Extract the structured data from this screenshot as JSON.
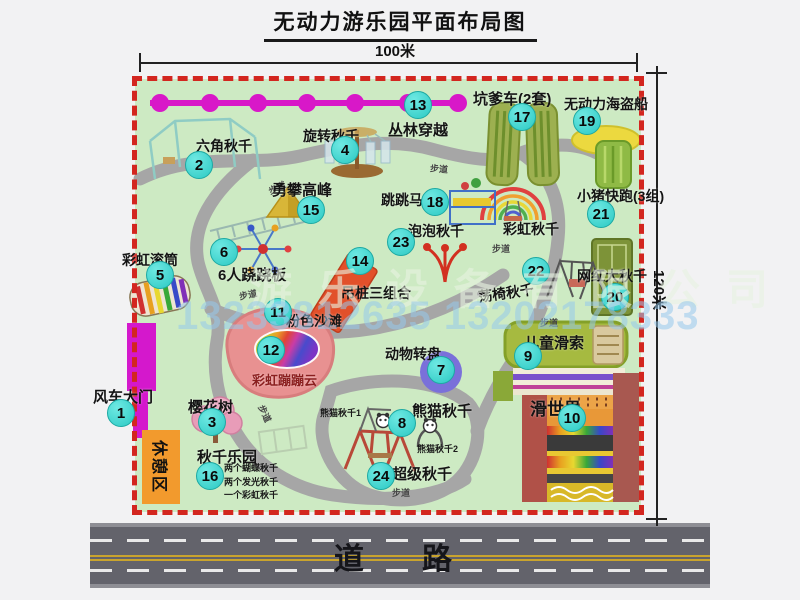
{
  "title": "无动力游乐园平面布局图",
  "dimensions": {
    "width": "100米",
    "height": "120米"
  },
  "road": {
    "label": "道　路"
  },
  "watermark": {
    "company": "游乐设备有限公司",
    "phone": "13233812635 13202178333"
  },
  "park": {
    "rest_area_label": "休憩区",
    "attractions": [
      {
        "num": "1",
        "label": "风车大门",
        "badge": [
          121,
          413
        ],
        "label_pos": [
          93,
          386
        ],
        "label_size": 15
      },
      {
        "num": "2",
        "label": "六角秋千",
        "badge": [
          199,
          165
        ],
        "label_pos": [
          196,
          136
        ],
        "label_size": 14
      },
      {
        "num": "3",
        "label": "樱花树",
        "badge": [
          212,
          422
        ],
        "label_pos": [
          188,
          396
        ],
        "label_size": 15
      },
      {
        "num": "4",
        "label": "旋转秋千",
        "badge": [
          345,
          150
        ],
        "label_pos": [
          303,
          126
        ],
        "label_size": 14
      },
      {
        "num": "5",
        "label": "彩虹滚筒",
        "badge": [
          160,
          275
        ],
        "label_pos": [
          122,
          250
        ],
        "label_size": 14
      },
      {
        "num": "6",
        "label": "6人跷跷板",
        "badge": [
          224,
          252
        ],
        "label_pos": [
          218,
          264
        ],
        "label_size": 15
      },
      {
        "num": "7",
        "label": "动物转盘",
        "badge": [
          441,
          370
        ],
        "label_pos": [
          385,
          344
        ],
        "label_size": 14
      },
      {
        "num": "8",
        "label": "熊猫秋千",
        "badge": [
          402,
          423
        ],
        "label_pos": [
          412,
          400
        ],
        "label_size": 15,
        "sub_labels": [
          {
            "text": "熊猫秋千1",
            "pos": [
              320,
              406
            ]
          },
          {
            "text": "熊猫秋千2",
            "pos": [
              417,
              442
            ]
          }
        ]
      },
      {
        "num": "9",
        "label": "儿童滑索",
        "badge": [
          528,
          356
        ],
        "label_pos": [
          524,
          332
        ],
        "label_size": 15
      },
      {
        "num": "10",
        "label": "滑世界",
        "badge": [
          572,
          418
        ],
        "label_pos": [
          530,
          395
        ],
        "label_size": 17
      },
      {
        "num": "11",
        "label": "粉色沙滩",
        "badge": [
          278,
          312
        ],
        "label_pos": [
          286,
          311
        ],
        "label_size": 14
      },
      {
        "num": "12",
        "label": "彩虹蹦蹦云",
        "badge": [
          271,
          350
        ],
        "label_pos": [
          252,
          370
        ],
        "label_size": 13,
        "label_color": "#8b1f1f"
      },
      {
        "num": "13",
        "label": "丛林穿越",
        "badge": [
          418,
          105
        ],
        "label_pos": [
          388,
          119
        ],
        "label_size": 15
      },
      {
        "num": "14",
        "label": "吊桩三组合",
        "badge": [
          360,
          261
        ],
        "label_pos": [
          341,
          283
        ],
        "label_size": 14
      },
      {
        "num": "15",
        "label": "勇攀高峰",
        "badge": [
          311,
          210
        ],
        "label_pos": [
          272,
          179
        ],
        "label_size": 15
      },
      {
        "num": "16",
        "label": "秋千乐园",
        "badge": [
          210,
          476
        ],
        "label_pos": [
          197,
          446
        ],
        "label_size": 15,
        "notes": [
          "两个蝴蝶秋千",
          "两个发光秋千",
          "一个彩虹秋千"
        ],
        "notes_pos": [
          224,
          462
        ]
      },
      {
        "num": "17",
        "label": "坑爹车(2套)",
        "badge": [
          522,
          117
        ],
        "label_pos": [
          473,
          88
        ],
        "label_size": 15
      },
      {
        "num": "18",
        "label": "跳跳马",
        "badge": [
          435,
          202
        ],
        "label_pos": [
          381,
          190
        ],
        "label_size": 14
      },
      {
        "num": "19",
        "label": "无动力海盗船",
        "badge": [
          587,
          121
        ],
        "label_pos": [
          564,
          94
        ],
        "label_size": 14
      },
      {
        "num": "20",
        "label": "网红大秋千",
        "badge": [
          615,
          297
        ],
        "label_pos": [
          577,
          266
        ],
        "label_size": 14
      },
      {
        "num": "21",
        "label": "小猪快跑(3组)",
        "badge": [
          601,
          214
        ],
        "label_pos": [
          577,
          186
        ],
        "label_size": 14
      },
      {
        "num": "22",
        "label": "荡椅秋千",
        "badge": [
          536,
          271
        ],
        "label_pos": [
          478,
          283
        ],
        "label_size": 14,
        "label_rot": -8
      },
      {
        "num": "23",
        "label": "泡泡秋千",
        "badge": [
          401,
          242
        ],
        "label_pos": [
          408,
          221
        ],
        "label_size": 14
      },
      {
        "num": "24",
        "label": "超级秋千",
        "badge": [
          381,
          476
        ],
        "label_pos": [
          392,
          463
        ],
        "label_size": 15
      }
    ],
    "extra_labels": [
      {
        "text": "彩虹秋千",
        "pos": [
          503,
          219
        ],
        "size": 14
      }
    ],
    "path_label_text": "步道",
    "path_labels": [
      {
        "pos": [
          268,
          181
        ],
        "rot": -25
      },
      {
        "pos": [
          430,
          162
        ],
        "rot": 5
      },
      {
        "pos": [
          492,
          242
        ],
        "rot": 0
      },
      {
        "pos": [
          239,
          288
        ],
        "rot": -12
      },
      {
        "pos": [
          256,
          407
        ],
        "rot": 65
      },
      {
        "pos": [
          392,
          486
        ],
        "rot": 0
      },
      {
        "pos": [
          540,
          316
        ],
        "rot": 0
      }
    ]
  }
}
